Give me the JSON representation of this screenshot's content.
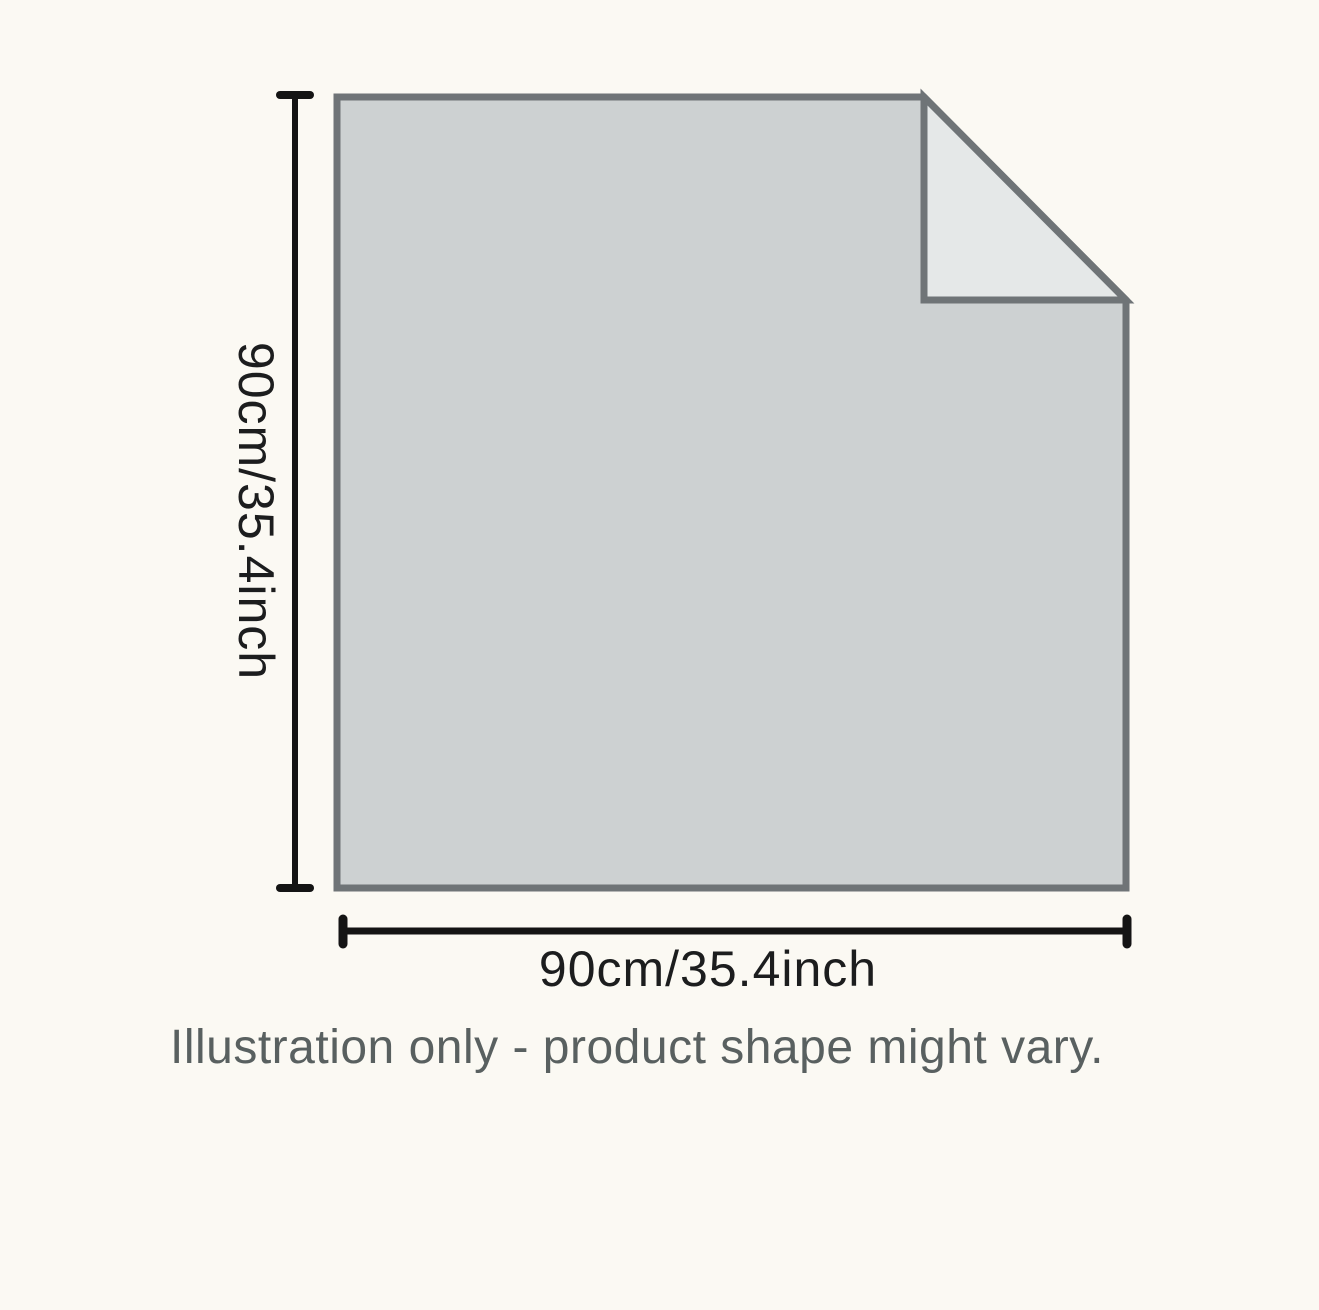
{
  "illustration": {
    "height_label": "90cm/35.4inch",
    "width_label": "90cm/35.4inch",
    "note": "Illustration only - product shape might vary.",
    "colors": {
      "background": "#fbf9f3",
      "sheet_fill": "#cdd1d2",
      "sheet_border": "#6f7477",
      "fold_fill": "#e5e8e8",
      "dimension_line": "#141414"
    }
  }
}
